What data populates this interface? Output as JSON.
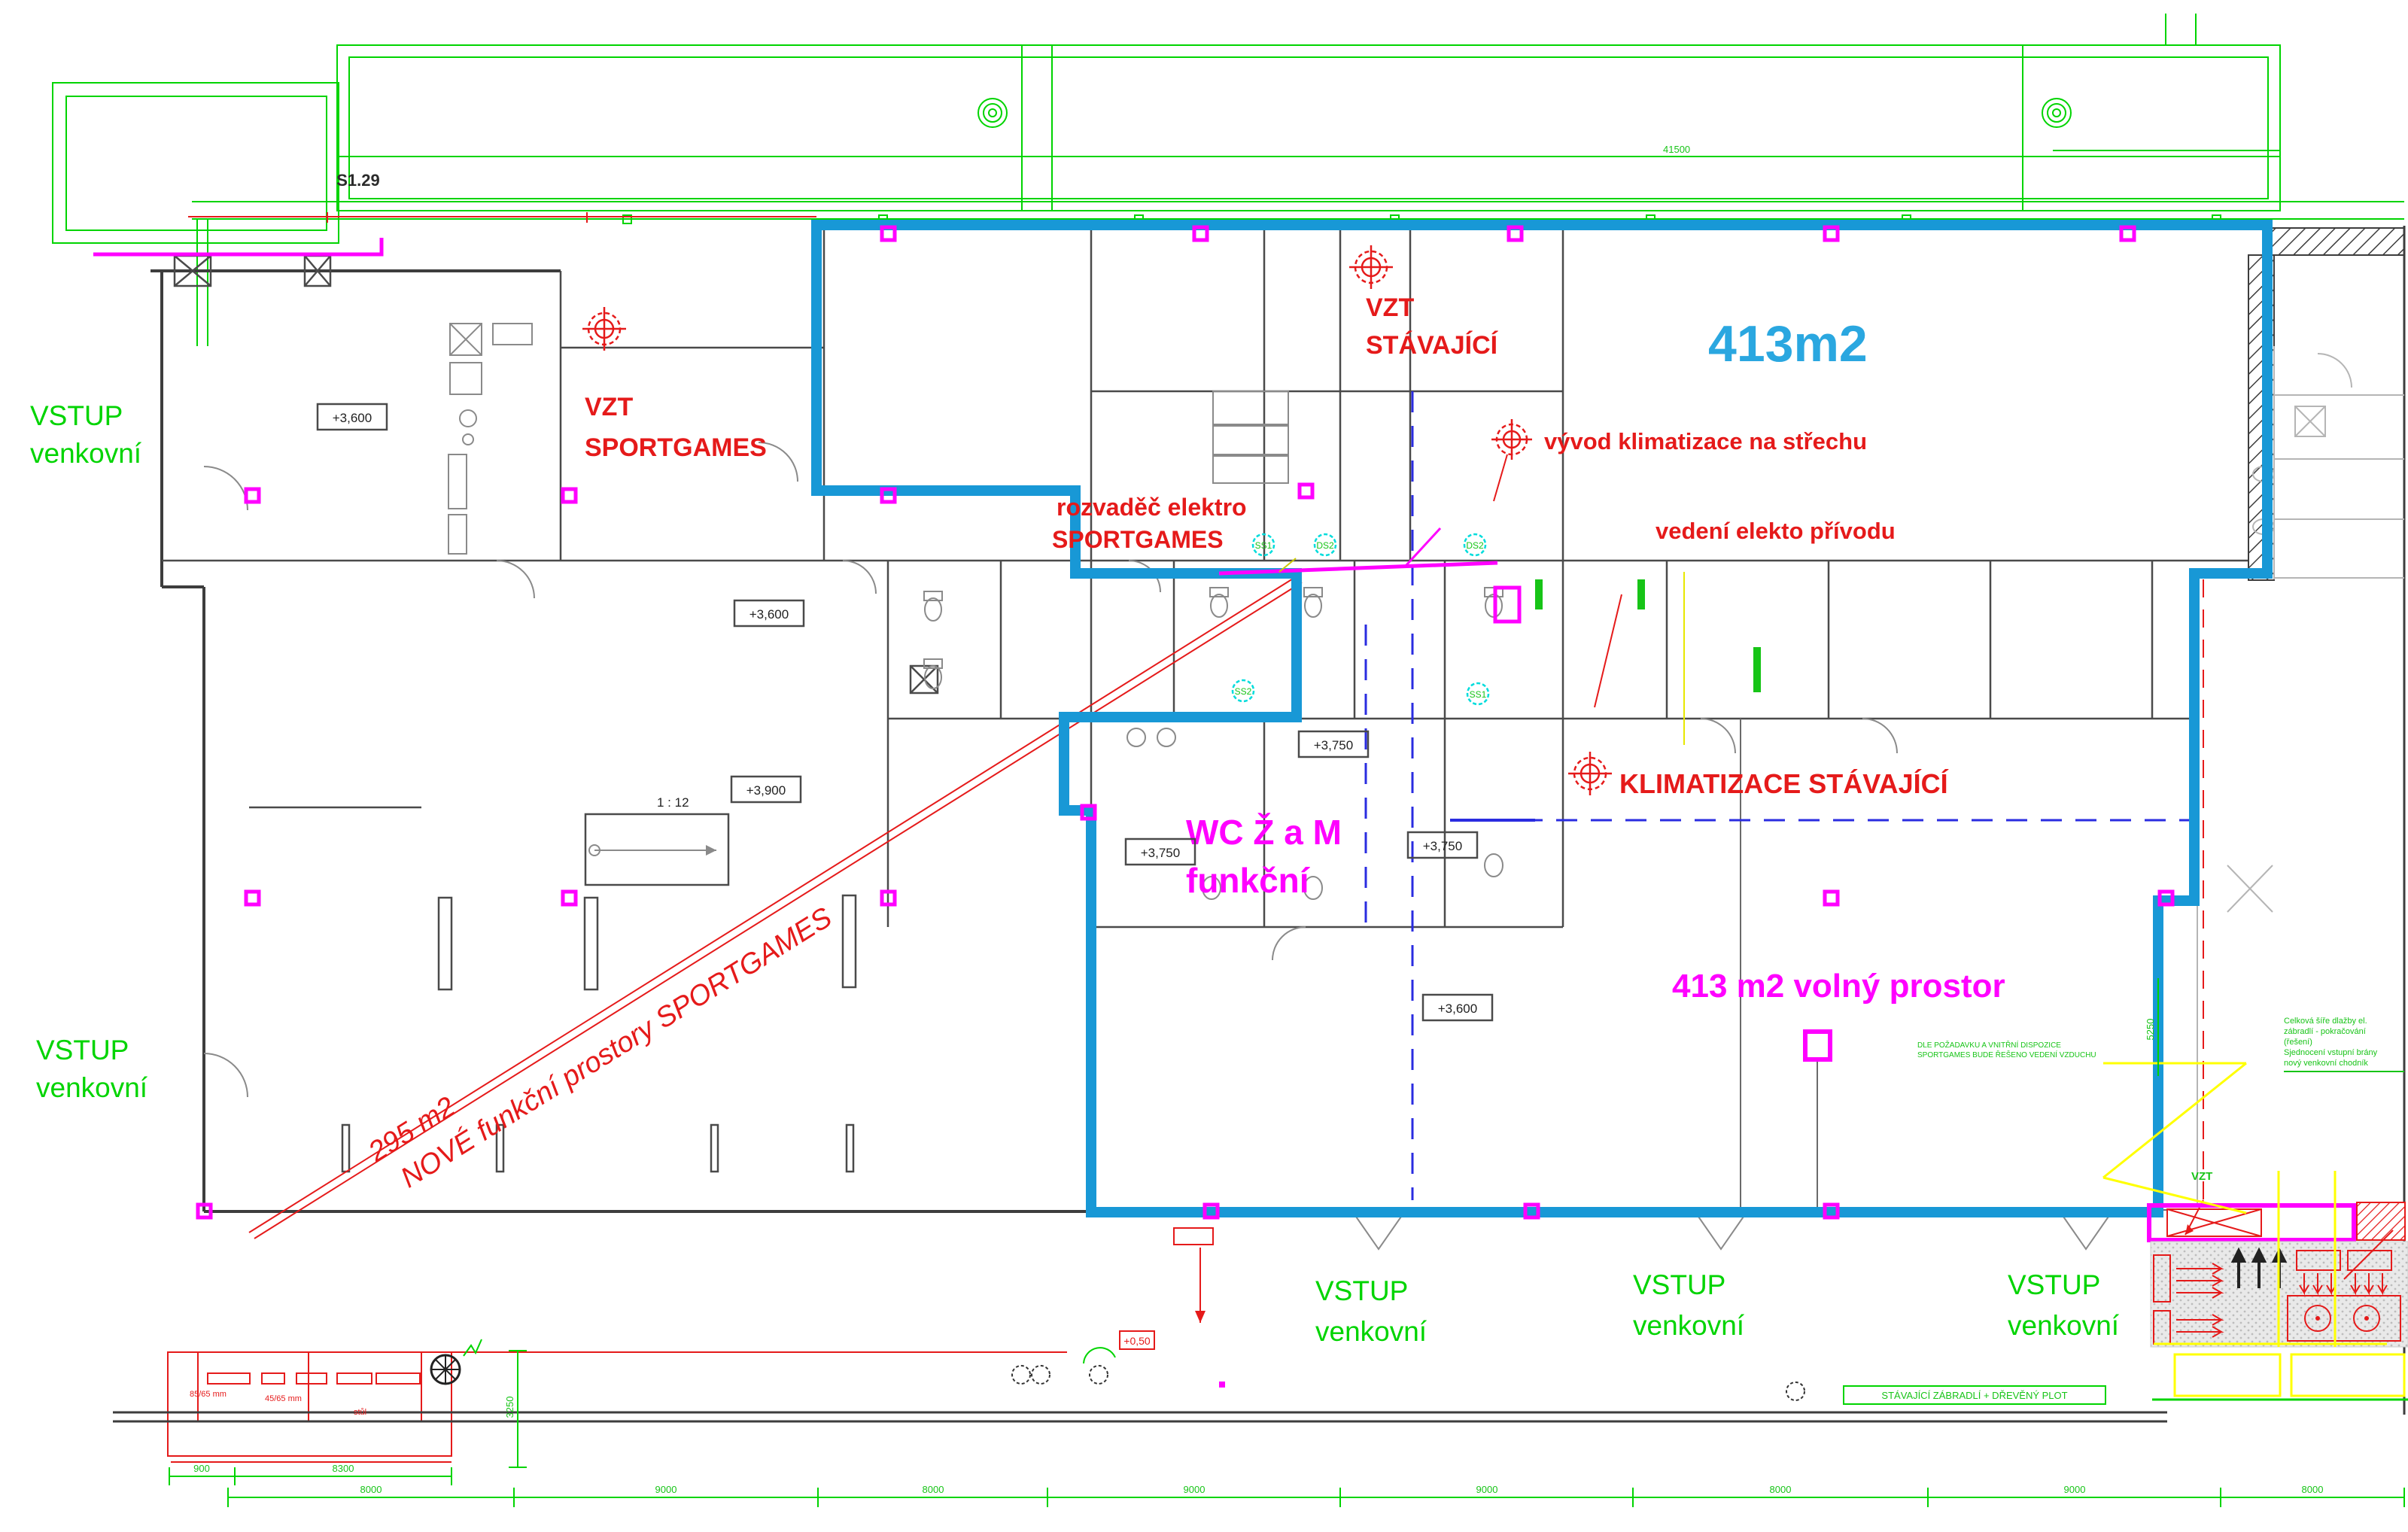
{
  "colors": {
    "boundary_blue": "#1898d6",
    "area_blue_text": "#2aa7e0",
    "annotation_red": "#e51a1a",
    "highlight_magenta": "#ff00ff",
    "site_green": "#00d400",
    "wall_grey": "#3d3d3d",
    "dash_blue": "#2a2ce0",
    "symbol_cyan": "#00dcdc",
    "yellow": "#ffff00"
  },
  "title": {
    "room_code": "S1.29"
  },
  "areas": {
    "main_area": "413m2",
    "free_space": "413 m2 volný prostor",
    "diag_line1": "295 m2",
    "diag_line2": "NOVÉ funkční prostory SPORTGAMES"
  },
  "hvac": {
    "vzt1_l1": "VZT",
    "vzt1_l2": "SPORTGAMES",
    "vzt2_l1": "VZT",
    "vzt2_l2": "STÁVAJÍCÍ",
    "vyvod": "vývod klimatizace na střechu",
    "vedeni": "vedení elekto přívodu",
    "rozvadec_l1": "rozvaděč elektro",
    "rozvadec_l2": "SPORTGAMES",
    "klimatizace": "KLIMATIZACE STÁVAJÍCÍ",
    "vzt_small": "VZT"
  },
  "wc": {
    "l1": "WC Ž a M",
    "l2": "funkční"
  },
  "entrances": [
    {
      "l1": "VSTUP",
      "l2": "venkovní"
    },
    {
      "l1": "VSTUP",
      "l2": "venkovní"
    },
    {
      "l1": "VSTUP",
      "l2": "venkovní"
    },
    {
      "l1": "VSTUP",
      "l2": "venkovní"
    },
    {
      "l1": "VSTUP",
      "l2": "venkovní"
    }
  ],
  "elevations": [
    "+3,600",
    "+3,600",
    "+3,900",
    "+3,750",
    "+3,750",
    "+3,750",
    "+3,600"
  ],
  "ramp": "1 : 12",
  "level_marker": "+0,50",
  "furniture": {
    "dim1": "85/65 mm",
    "dim2": "45/65 mm",
    "table": "stůl"
  },
  "symbols": [
    "SS1",
    "DS2",
    "DS2",
    "SS2",
    "SS1"
  ],
  "notes": {
    "right": [
      "Celková šíře dlažby el.",
      "zábradlí - pokračování",
      "(řešení)",
      "Sjednocení vstupní brány",
      "nový venkovní chodník"
    ],
    "left": [
      "DLE POŽADAVKU A VNITŘNÍ DISPOZICE",
      "SPORTGAMES BUDE ŘEŠENO VEDENÍ VZDUCHU"
    ],
    "fence": "STÁVAJÍCÍ ZÁBRADLÍ + DŘEVĚNÝ PLOT"
  },
  "dims": {
    "top": "41500",
    "upper1": "900",
    "upper2": "8300",
    "chain": [
      "8000",
      "9000",
      "8000",
      "9000",
      "9000",
      "8000",
      "9000",
      "8000"
    ],
    "v1": "3250",
    "v2": "5250"
  }
}
